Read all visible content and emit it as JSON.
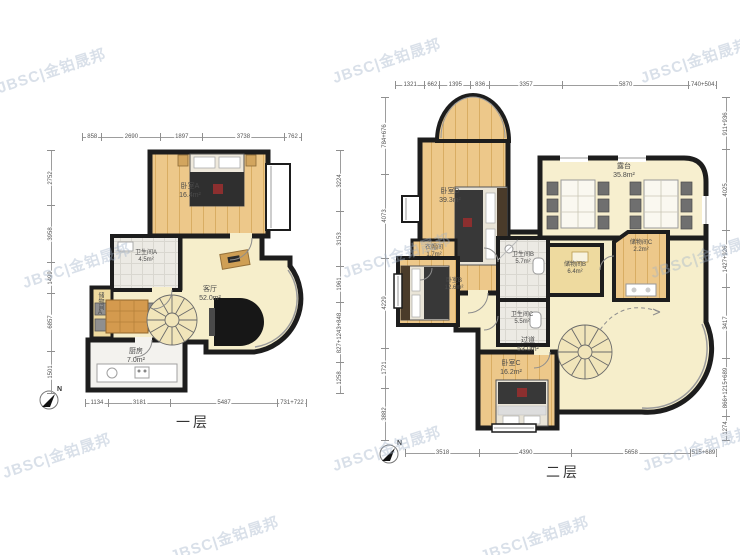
{
  "watermark": "JBSC|金铂晟邦",
  "colors": {
    "wall": "#1d1d1d",
    "wood_floor": "#edc88a",
    "cream_floor": "#f6eecb",
    "tile_floor": "#eceae4",
    "storage_floor": "#eeda9f",
    "dim_text": "#555555",
    "watermark_text": "#a0b2c8"
  },
  "floor1": {
    "title": "一层",
    "north": "N",
    "rooms": [
      {
        "name": "卧室A",
        "area": "16.4m²"
      },
      {
        "name": "卫生间A",
        "area": "4.5m²"
      },
      {
        "name": "客厅",
        "area": "52.0m²"
      },
      {
        "name": "储物间A",
        "area": ""
      },
      {
        "name": "厨房",
        "area": "7.0m²"
      }
    ],
    "dims_top": [
      "858",
      "2690",
      "1897",
      "3738",
      "762"
    ],
    "dims_bottom": [
      "1134",
      "3181",
      "5487",
      "731+722"
    ],
    "dims_left": [
      "2752",
      "3958",
      "1499",
      "6857",
      "1501"
    ],
    "dims_right": [
      "3224",
      "3153",
      "1961",
      "827+1243+848",
      "1258"
    ]
  },
  "floor2": {
    "title": "二层",
    "north": "N",
    "rooms": [
      {
        "name": "卧室D",
        "area": "39.3m²"
      },
      {
        "name": "露台",
        "area": "35.8m²"
      },
      {
        "name": "衣帽间",
        "area": "1.7m²"
      },
      {
        "name": "卫生间B",
        "area": "5.7m²"
      },
      {
        "name": "储物间B",
        "area": "6.4m²"
      },
      {
        "name": "储物间C",
        "area": "2.2m²"
      },
      {
        "name": "卧室B",
        "area": "12.6m²"
      },
      {
        "name": "卫生间C",
        "area": "5.5m²"
      },
      {
        "name": "过道",
        "area": "53.0m²"
      },
      {
        "name": "卧室C",
        "area": "16.2m²"
      }
    ],
    "dims_top": [
      "1321",
      "662",
      "1395",
      "836",
      "3357",
      "5870",
      "740+504"
    ],
    "dims_bottom": [
      "3518",
      "4390",
      "5658",
      "515+689"
    ],
    "dims_left": [
      "784+676",
      "4073",
      "4229",
      "1721",
      "3882"
    ],
    "dims_right": [
      "911+936",
      "4025",
      "1427+926",
      "3417",
      "866+1215+689",
      "1274"
    ]
  }
}
